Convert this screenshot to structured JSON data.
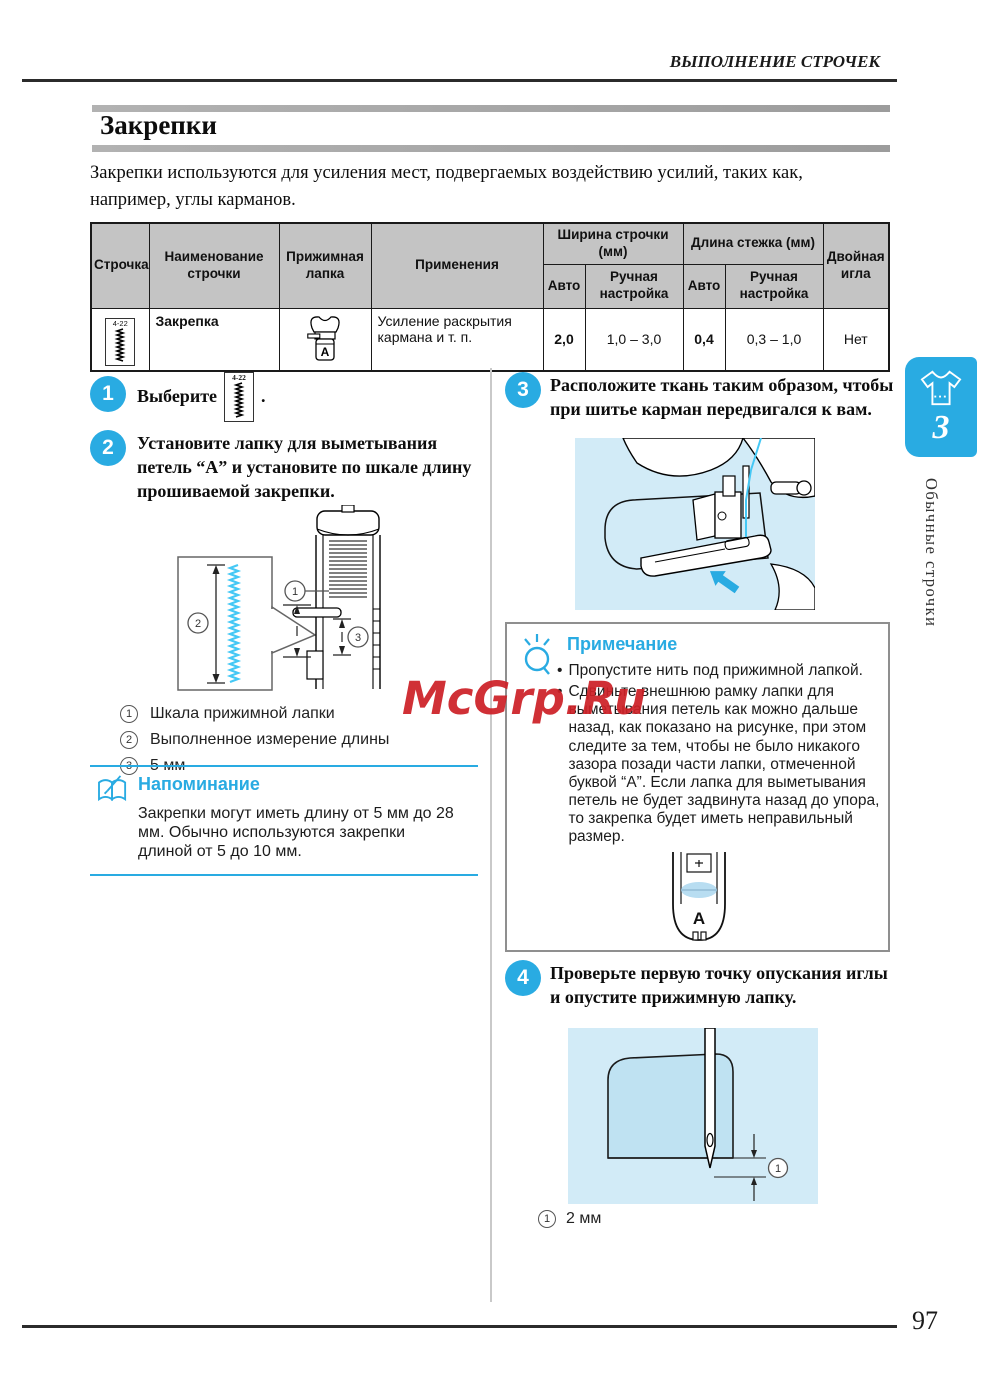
{
  "page": {
    "header": "ВЫПОЛНЕНИЕ СТРОЧЕК",
    "title": "Закрепки",
    "intro": "Закрепки используются для усиления мест, подвергаемых воздействию усилий, таких как, например, углы карманов.",
    "page_number": "97",
    "watermark": "McGrp.Ru"
  },
  "sidebar": {
    "chapter_number": "3",
    "chapter_label": "Обычные строчки"
  },
  "table": {
    "col_stitch": "Строчка",
    "col_name": "Наименование строчки",
    "col_foot": "Прижимная лапка",
    "col_application": "Применения",
    "col_width": "Ширина строчки (мм)",
    "col_length": "Длина стежка (мм)",
    "col_auto1": "Авто",
    "col_manual1": "Ручная настройка",
    "col_auto2": "Авто",
    "col_manual2": "Ручная настройка",
    "col_twin": "Двойная игла",
    "row": {
      "stitch_label": "4-22",
      "name": "Закрепка",
      "foot_letter": "A",
      "application": "Усиление раскрытия кармана и т. п.",
      "width_auto": "2,0",
      "width_manual": "1,0 – 3,0",
      "length_auto": "0,4",
      "length_manual": "0,3 – 1,0",
      "twin": "Нет"
    }
  },
  "steps": {
    "s1": {
      "number": "1",
      "before": "Выберите",
      "stitch_label": "4-22",
      "after": "."
    },
    "s2": {
      "number": "2",
      "text": "Установите лапку для выметывания петель “А” и установите по шкале длину прошиваемой закрепки."
    },
    "s3": {
      "number": "3",
      "text": "Расположите ткань таким образом, чтобы при шитье карман передвигался к вам."
    },
    "s4": {
      "number": "4",
      "text": "Проверьте первую точку опускания иглы и опустите прижимную лапку."
    }
  },
  "legend": {
    "item1": {
      "num": "1",
      "text": "Шкала прижимной лапки"
    },
    "item2": {
      "num": "2",
      "text": "Выполненное измерение длины"
    },
    "item3": {
      "num": "3",
      "text": "5 мм"
    }
  },
  "reminder": {
    "title": "Напоминание",
    "text": "Закрепки могут иметь длину от 5 мм до 28 мм. Обычно используются закрепки длиной от 5 до 10 мм."
  },
  "note": {
    "title": "Примечание",
    "bullet1": "Пропустите нить под прижимной лапкой.",
    "bullet2": "Сдвиньте внешнюю рамку лапки для выметывания петель как можно дальше назад, как показано на рисунке, при этом следите за тем, чтобы не было никакого зазора позади части лапки, отмеченной буквой “А”. Если лапка для выметывания петель не будет задвинута назад до упора, то закрепка будет иметь неправильный размер.",
    "foot_letter": "A"
  },
  "caption": {
    "num": "1",
    "text": "2 мм"
  },
  "diagram": {
    "m1": "1",
    "m2": "2",
    "m3": "3"
  },
  "colors": {
    "accent": "#29abe2",
    "light_cyan": "#45c8f5",
    "watermark_red": "#cd2127",
    "table_header_bg": "#c4c4c4",
    "illustration_bg": "#d2ebf7"
  }
}
